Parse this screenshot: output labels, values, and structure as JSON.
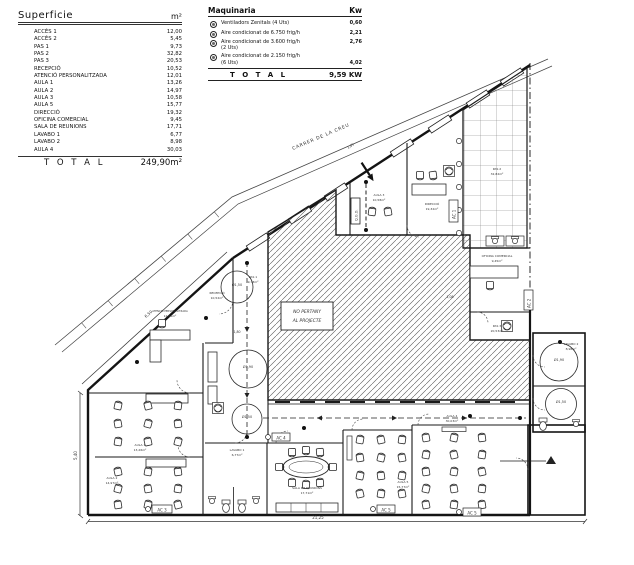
{
  "superficie_table": {
    "title": "Superficie",
    "unit_header": "m²",
    "rows": [
      {
        "label": "ACCÉS 1",
        "value": "12,00"
      },
      {
        "label": "ACCÉS 2",
        "value": "5,45"
      },
      {
        "label": "PAS 1",
        "value": "9,73"
      },
      {
        "label": "PAS 2",
        "value": "32,82"
      },
      {
        "label": "PAS 3",
        "value": "20,53"
      },
      {
        "label": "RECEPCIÓ",
        "value": "10,52"
      },
      {
        "label": "ATENCIÓ PERSONALITZADA",
        "value": "12,01"
      },
      {
        "label": "AULA 1",
        "value": "13,26"
      },
      {
        "label": "AULA 2",
        "value": "14,97"
      },
      {
        "label": "AULA 3",
        "value": "10,58"
      },
      {
        "label": "AULA 5",
        "value": "15,77"
      },
      {
        "label": "DIRECCIÓ",
        "value": "19,32"
      },
      {
        "label": "OFICINA COMERCIAL",
        "value": "9,45"
      },
      {
        "label": "SALA DE REUNIONS",
        "value": "17,71"
      },
      {
        "label": "LAVABO 1",
        "value": "6,77"
      },
      {
        "label": "LAVABO 2",
        "value": "8,98"
      },
      {
        "label": "AULA 4",
        "value": "30,03"
      }
    ],
    "total_label": "T O T A L",
    "total_value": "249,90m²"
  },
  "maquinaria_table": {
    "title": "Maquinaria",
    "unit_header": "Kw",
    "rows": [
      {
        "label": "Ventiladors Zenitals (4 Uts)",
        "value": "0,60"
      },
      {
        "label": "Aire condicionat de 6.750 frig/h",
        "value": "2,21"
      },
      {
        "label": "Aire condicionat de 3.600 frig/h\n(2 Uts)",
        "value": "2,76"
      },
      {
        "label": "Aire condicionat de 2.150 frig/h\n(6 Uts)",
        "value": "4,02"
      }
    ],
    "total_label": "T O T A L",
    "total_value": "9,59 KW"
  },
  "plan": {
    "street_name": "CARRER DE LA CREU",
    "excluded_line1": "NO PERTANY",
    "excluded_line2": "AL PROJECTE",
    "panel_label": "Q.G.D.",
    "rooms": [
      {
        "name": "RECEPCIÓ",
        "area": "10,52m²"
      },
      {
        "name": "PAS 1",
        "area": "9,73m²"
      },
      {
        "name": "ATENCIÓ PERSONALITZADA",
        "area": "12,01m²"
      },
      {
        "name": "AULA 1",
        "area": "13,26m²"
      },
      {
        "name": "AULA 2",
        "area": "14,97m²"
      },
      {
        "name": "AULA 3",
        "area": "10,58m²"
      },
      {
        "name": "DIRECCIÓ",
        "area": "19,32m²"
      },
      {
        "name": "PAS 2",
        "area": "32,82m²"
      },
      {
        "name": "OFICINA COMERCIAL",
        "area": "9,45m²"
      },
      {
        "name": "PAS 3",
        "area": "20,53m²"
      },
      {
        "name": "LAVABO 1",
        "area": "6,77m²"
      },
      {
        "name": "SALA DE REUNIONS",
        "area": "17,71m²"
      },
      {
        "name": "AULA 5",
        "area": "15,77m²"
      },
      {
        "name": "AULA 4",
        "area": "30,03m²"
      },
      {
        "name": "LAVABO 2",
        "area": "8,98m²"
      }
    ],
    "circles": [
      "Ø1,50",
      "Ø1,90",
      "Ø1,50",
      "Ø1,90",
      "Ø1,50"
    ],
    "ac_units": [
      "AC 1",
      "AC 2",
      "AC 3",
      "AC 4",
      "AC 5",
      "AC 5"
    ],
    "dimensions": {
      "bottom": "21,25",
      "left": "5,40",
      "facade": "6,50",
      "entry": "1,05",
      "corridor": "1,80",
      "office": "1,08"
    }
  }
}
